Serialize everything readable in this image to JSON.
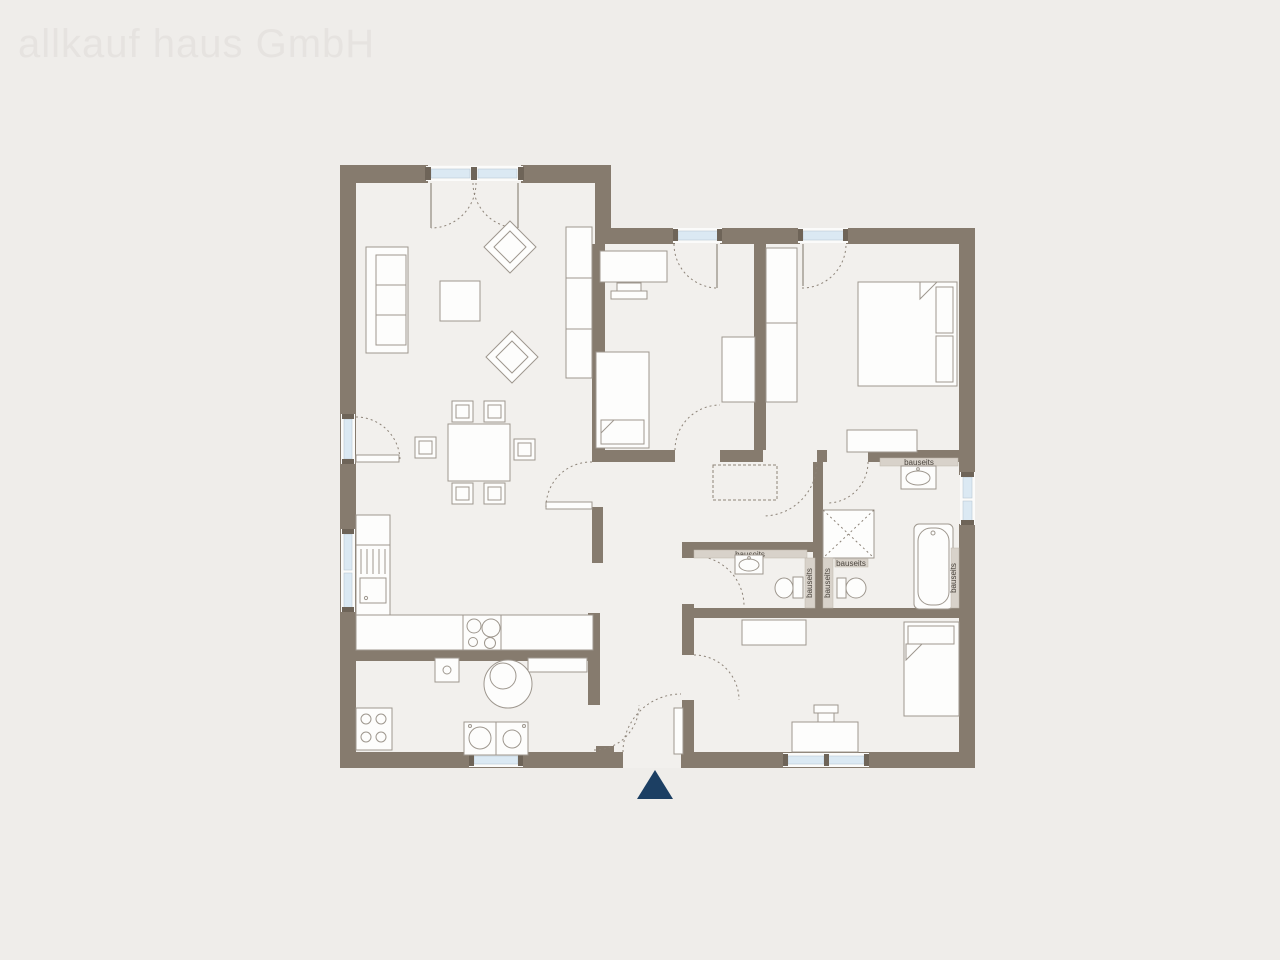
{
  "watermark": "allkauf haus GmbH",
  "labels": {
    "bauseits": "bauseits"
  },
  "icons": {
    "entrance_marker": "filled-triangle-up"
  },
  "colors": {
    "background": "#efedea",
    "floor": "#f2f0ed",
    "wall": "#867b6e",
    "window_glass": "#dbe9f3",
    "window_frame": "#fbfbfa",
    "installation_strip": "#d8d2ca",
    "furniture_outline": "#9e978e",
    "door_arc": "#8d8378",
    "entrance_marker": "#1c3f63",
    "watermark_text": "#e6e3e0"
  }
}
